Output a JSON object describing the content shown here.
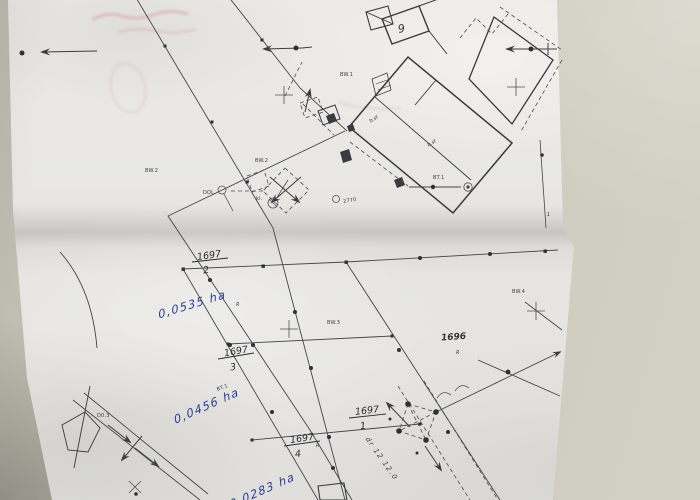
{
  "document": {
    "type": "cadastral-sketch-photo",
    "ink_color": "#45464b",
    "handwriting_color": "#2b3c94"
  },
  "parcels": {
    "a": {
      "num": "1697",
      "den": "2"
    },
    "b": {
      "num": "1697",
      "den": "3"
    },
    "c": {
      "num": "1697",
      "den": "1"
    },
    "d": {
      "num": "1697",
      "den": "4"
    },
    "neighbor": "1696"
  },
  "handwriting": {
    "area_a": "0,0535 ha",
    "area_b": "0,0456 ha",
    "area_d": "0,0283 ha"
  },
  "labels": {
    "bldg9": "9",
    "bw1": "BW.1",
    "bw2a": "BW.2",
    "bw2b": "BW.2",
    "bw3": "BW.3",
    "bw4": "BW.4",
    "bst_a": "b.st",
    "bst_b": "b.st",
    "bt_a": "BT.1",
    "bt_b": "BT.1",
    "dol": "DOL.",
    "kl": "kl.",
    "pt2770": "2770",
    "d03": "D0.3",
    "road": "dr 12 12.0",
    "one": "1",
    "r_a": "R",
    "r_neighbor": "R",
    "r_d": "R"
  }
}
